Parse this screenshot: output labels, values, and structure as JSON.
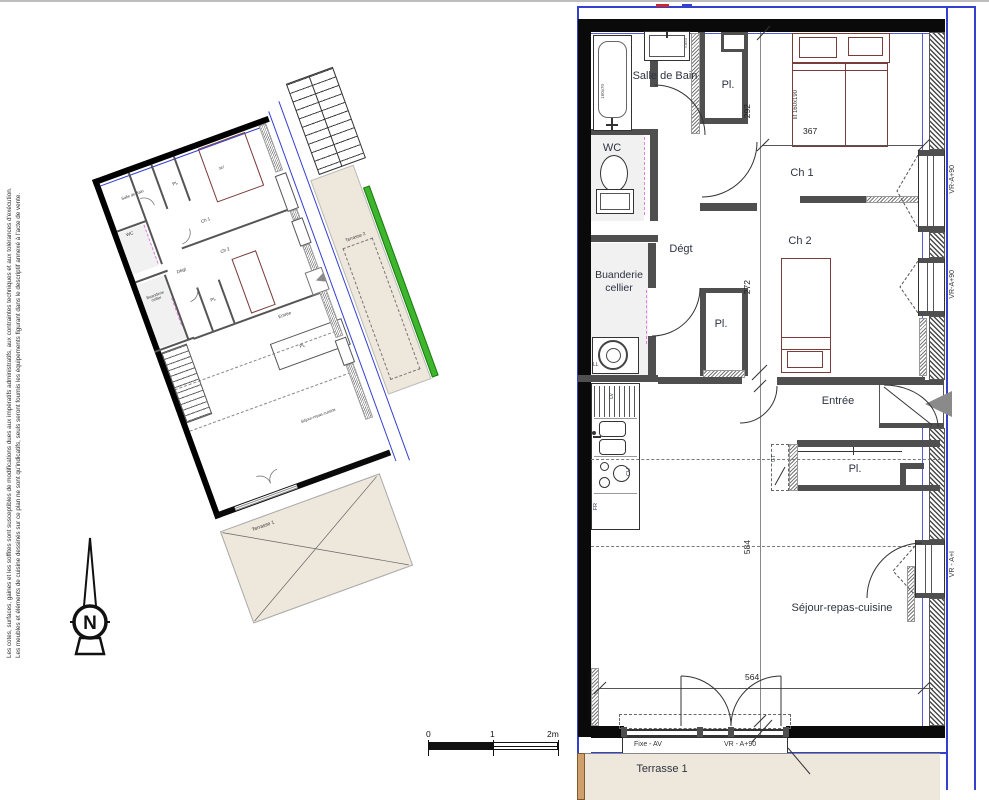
{
  "disclaimer": {
    "line1": "Les cotes, surfaces, gaines et les soffites sont susceptibles de modifications dues aux impératifs administratifs, aux contraintes techniques et aux tolérances d'exécution.",
    "line2": "Les meubles et éléments de cuisine dessinés sur ce plan ne sont qu'indicatifs, seuls seront fournis les équipements figurant dans le descriptif annexé à l'acte de vente."
  },
  "north_label": "N",
  "scale_bar": {
    "tick0": "0",
    "tick1": "1",
    "tick2": "2m"
  },
  "main_plan": {
    "rooms": {
      "salle_de_bain": "Salle de Bain",
      "wc": "WC",
      "placard_haut": "Pl.",
      "chambre1": "Ch 1",
      "chambre2": "Ch 2",
      "degagement": "Dégt",
      "buanderie_ligne1": "Buanderie",
      "buanderie_ligne2": "cellier",
      "placard_milieu": "Pl.",
      "entree": "Entrée",
      "placard_entree": "Pl.",
      "sejour": "Séjour-repas-cuisine",
      "terrasse1": "Terrasse 1"
    },
    "dimensions": {
      "ch1_largeur": "367",
      "couloir": "292",
      "placard_hauteur": "272",
      "sejour_hauteur": "584",
      "sejour_largeur": "564",
      "terrasse_profondeur": "180",
      "lit": "lit 160x190",
      "baignoire": "160x70",
      "vasque": "70x50"
    },
    "menuiseries": {
      "fenetre_ch1": "VR-A+90",
      "fenetre_ch2": "VR-A+90",
      "fenetre_sejour": "VR - A+I",
      "baie_fixe": "Fixe - AV",
      "baie_vr": "VR - A+90"
    },
    "equipements": {
      "lave_vaisselle": "LV",
      "cuisson": "CU",
      "refrigerateur": "FR",
      "lave_linge": "LL",
      "gaine_technique": "GT"
    }
  },
  "mini_plan": {
    "rooms": {
      "salle_de_bain": "Salle de Bain",
      "wc": "WC",
      "placard_haut": "PL",
      "chambre1": "Ch 1",
      "chambre2": "Ch 2",
      "degagement": "Dégt",
      "buanderie": "Buanderie cellier",
      "placard_milieu": "PL",
      "entree": "Entrée",
      "placard_entree": "PL",
      "sejour": "Séjour-repas-cuisine",
      "terrasse1": "Terrasse 1",
      "terrasse2": "Terrasse 2"
    },
    "dims": {
      "ch1_largeur": "367"
    }
  },
  "colors": {
    "boundary_blue": "#3440cf",
    "terrace_beige": "#eee7db",
    "green_edge": "#3db52c",
    "bed_outline": "#7a3b3b",
    "magenta_dash": "#e07ee0"
  }
}
